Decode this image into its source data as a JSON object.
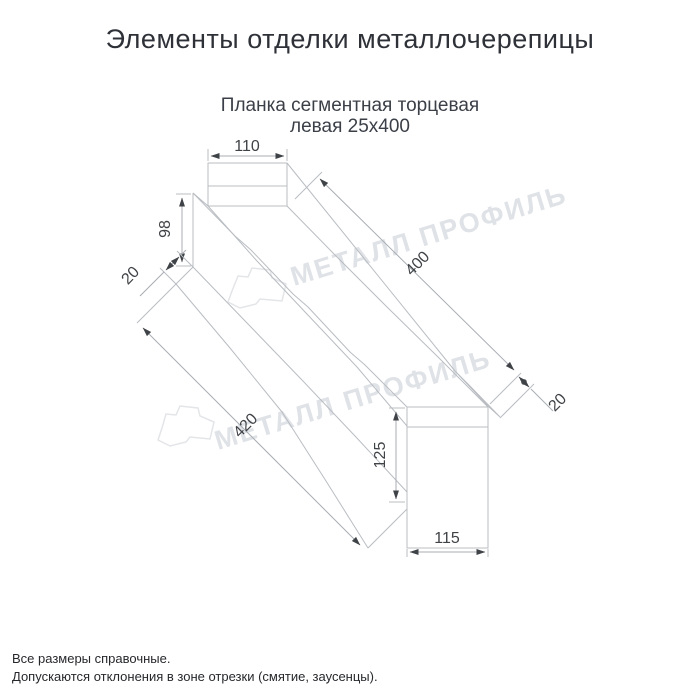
{
  "title": "Элементы отделки металлочерепицы",
  "subtitle": {
    "line1": "Планка сегментная торцевая",
    "line2": "левая 25х400"
  },
  "drawing": {
    "dimensions": {
      "top_flange_width": "110",
      "far_end_height": "98",
      "far_flange_width": "20",
      "top_edge_length": "400",
      "bottom_edge_length": "420",
      "near_hem_width": "20",
      "near_end_height": "125",
      "near_end_width": "115"
    }
  },
  "watermark": {
    "text": "МЕТАЛЛ ПРОФИЛЬ"
  },
  "footnotes": {
    "line1": "Все размеры справочные.",
    "line2": "Допускаются отклонения в зоне отрезки (смятие, заусенцы)."
  },
  "colors": {
    "background": "#ffffff",
    "shape_line": "#b9bdc2",
    "dimension_text": "#3f4246",
    "watermark": "#dfe2e6",
    "title_text": "#2e3138"
  }
}
